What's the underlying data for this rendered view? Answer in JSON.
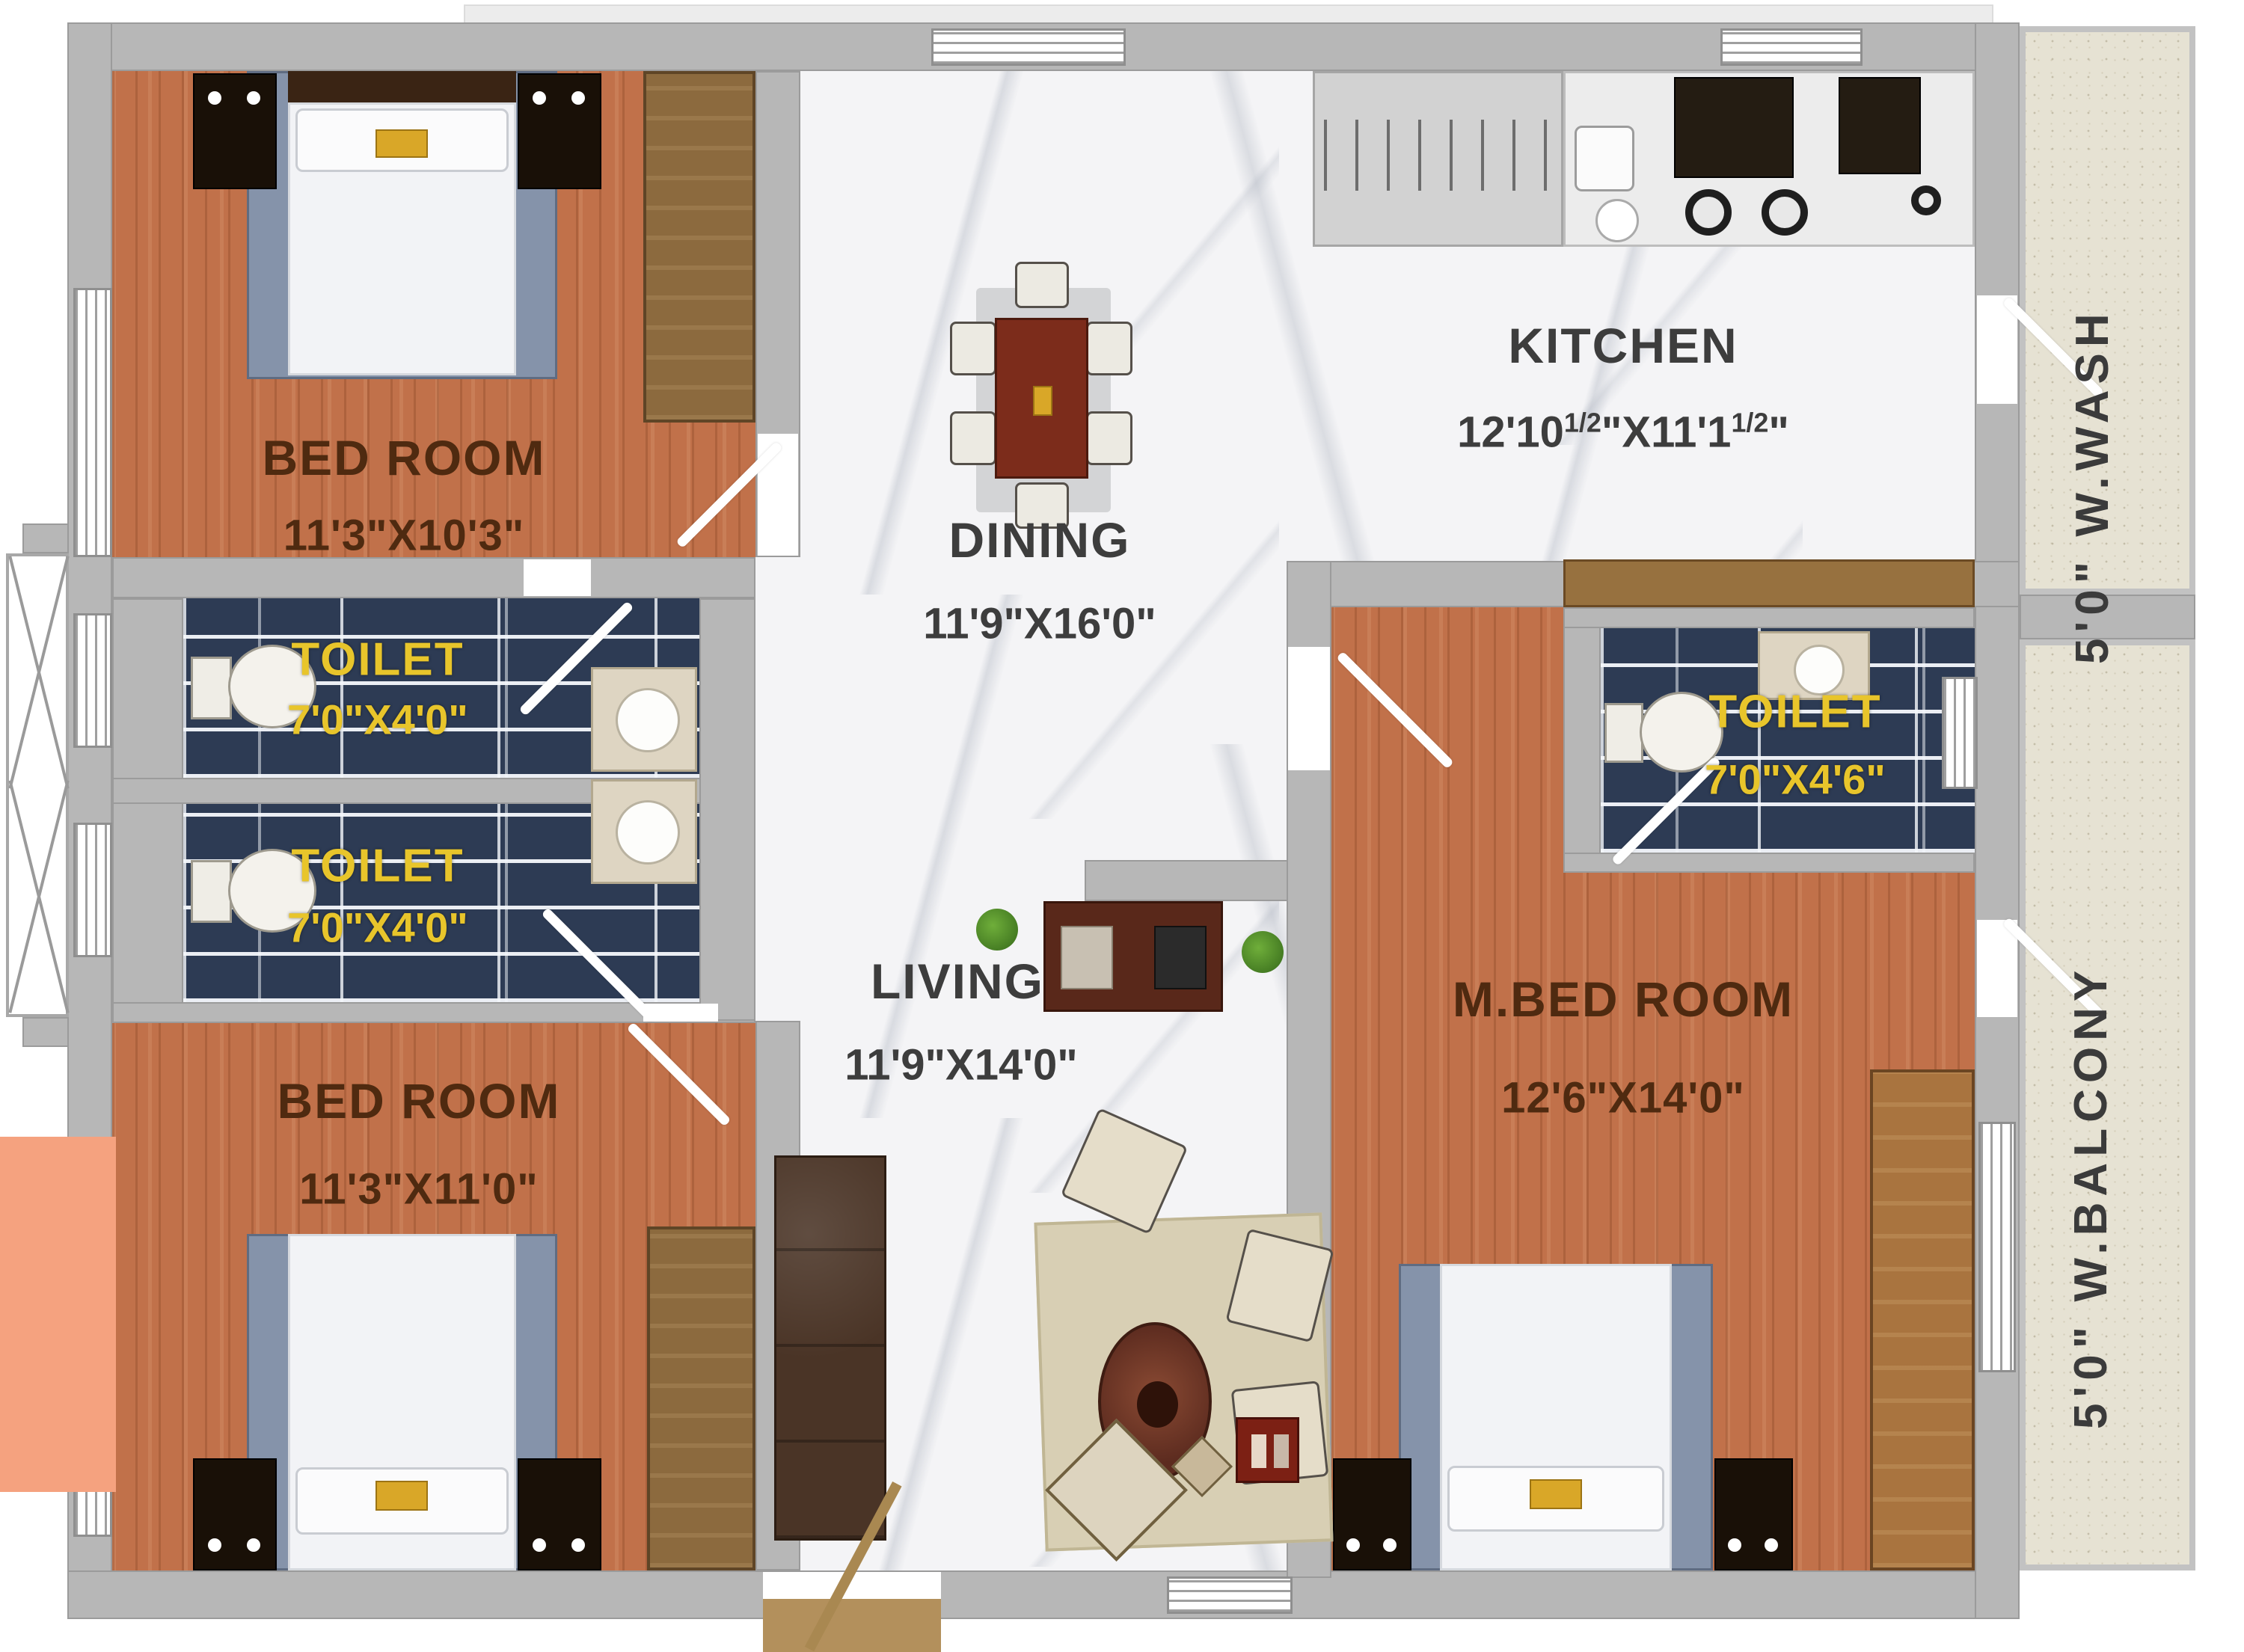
{
  "plan": {
    "type": "apartment-floor-plan",
    "rooms": {
      "bedroom_top": {
        "name": "BED ROOM",
        "dims": "11'3\"X10'3\""
      },
      "bedroom_bottom": {
        "name": "BED ROOM",
        "dims": "11'3\"X11'0\""
      },
      "master_bedroom": {
        "name": "M.BED ROOM",
        "dims": "12'6\"X14'0\""
      },
      "dining": {
        "name": "DINING",
        "dims": "11'9\"X16'0\""
      },
      "living": {
        "name": "LIVING",
        "dims": "11'9\"X14'0\""
      },
      "kitchen": {
        "name": "KITCHEN",
        "dims_a": "12'10",
        "dims_sup_a": "1/2",
        "dims_b": "\"X11'1",
        "dims_sup_b": "1/2",
        "dims_c": "\""
      },
      "toilet_left_top": {
        "name": "TOILET",
        "dims": "7'0\"X4'0\""
      },
      "toilet_left_bottom": {
        "name": "TOILET",
        "dims": "7'0\"X4'0\""
      },
      "toilet_master": {
        "name": "TOILET",
        "dims": "7'0\"X4'6\""
      }
    },
    "annotations": {
      "wash": "5'0\" W.WASH",
      "balcony": "5'0\" W.BALCONY"
    },
    "colors": {
      "wall": "#b7b7b7",
      "wood": "#c1714a",
      "tile": "#2d3b54",
      "marble": "#f4f4f6",
      "toilet_text": "#e8c52b",
      "room_text": "#4f2a10",
      "hall_text": "#3d3d3d",
      "salmon": "#f5a27f",
      "wardrobe": "#8c6a3e",
      "counter": "#d2d2d2",
      "speckle": "#e6e2d3"
    }
  }
}
